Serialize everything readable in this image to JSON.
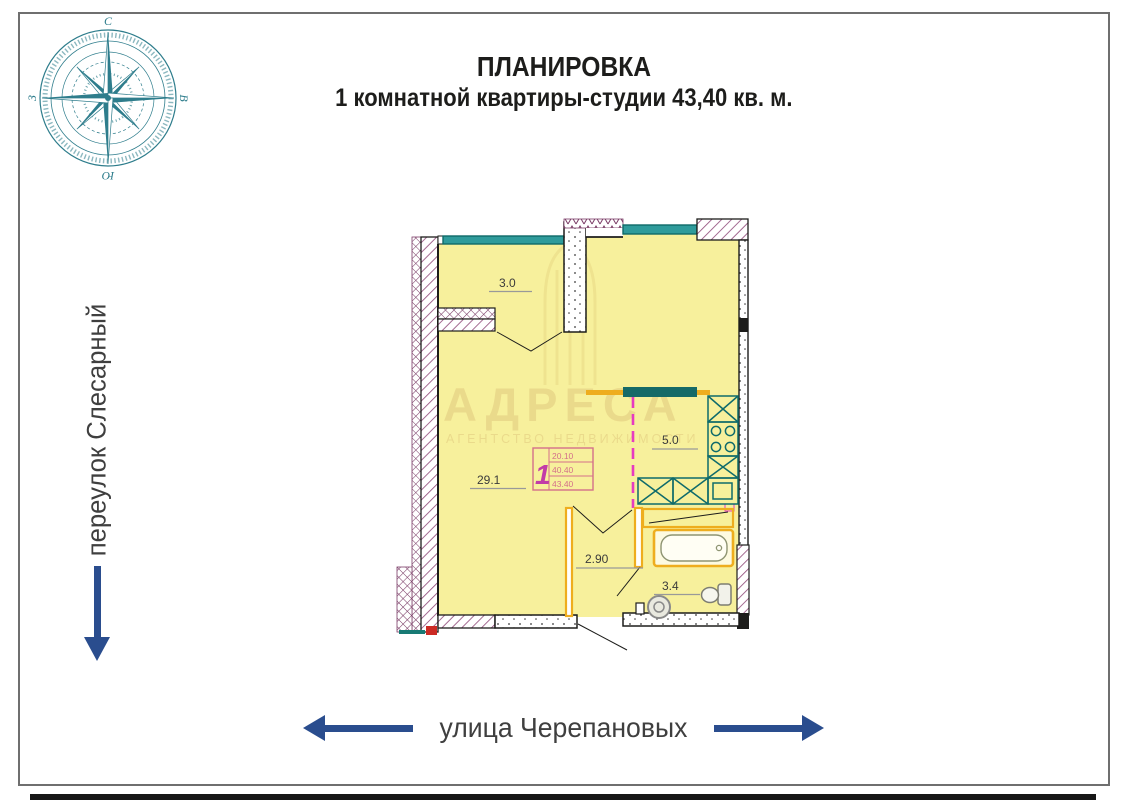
{
  "header": {
    "title_line1": "ПЛАНИРОВКА",
    "title_line2": "1 комнатной квартиры-студии 43,40 кв. м."
  },
  "streets": {
    "left_label": "переулок Слесарный",
    "bottom_label": "улица Черепановых"
  },
  "compass": {
    "top": "С",
    "right": "В",
    "bottom": "Ю",
    "left": "З"
  },
  "watermark": {
    "brand": "АДРЕСА",
    "tagline": "АГЕНТСТВО НЕДВИЖИМОСТИ"
  },
  "plan": {
    "rooms": [
      {
        "id": "loggia",
        "area_label": "3.0"
      },
      {
        "id": "living",
        "area_label": "29.1"
      },
      {
        "id": "kitchen",
        "area_label": "5.0"
      },
      {
        "id": "hallway",
        "area_label": "2.90"
      },
      {
        "id": "bathroom",
        "area_label": "3.4"
      }
    ],
    "stamp": {
      "apartment_number": "1",
      "row1": "20.10",
      "row2": "40.40",
      "row3": "43.40"
    }
  },
  "colors": {
    "navy": "#2a4d8e",
    "teal": "#2e7d8c",
    "ink": "#1d1d1b",
    "plan_yellow": "#f7f09c",
    "orange": "#eead1e",
    "magenta": "#e73bc0",
    "wall_hatch": "#94507e",
    "stamp_pink": "#d4708a",
    "window_teal": "#2f9b9b"
  }
}
